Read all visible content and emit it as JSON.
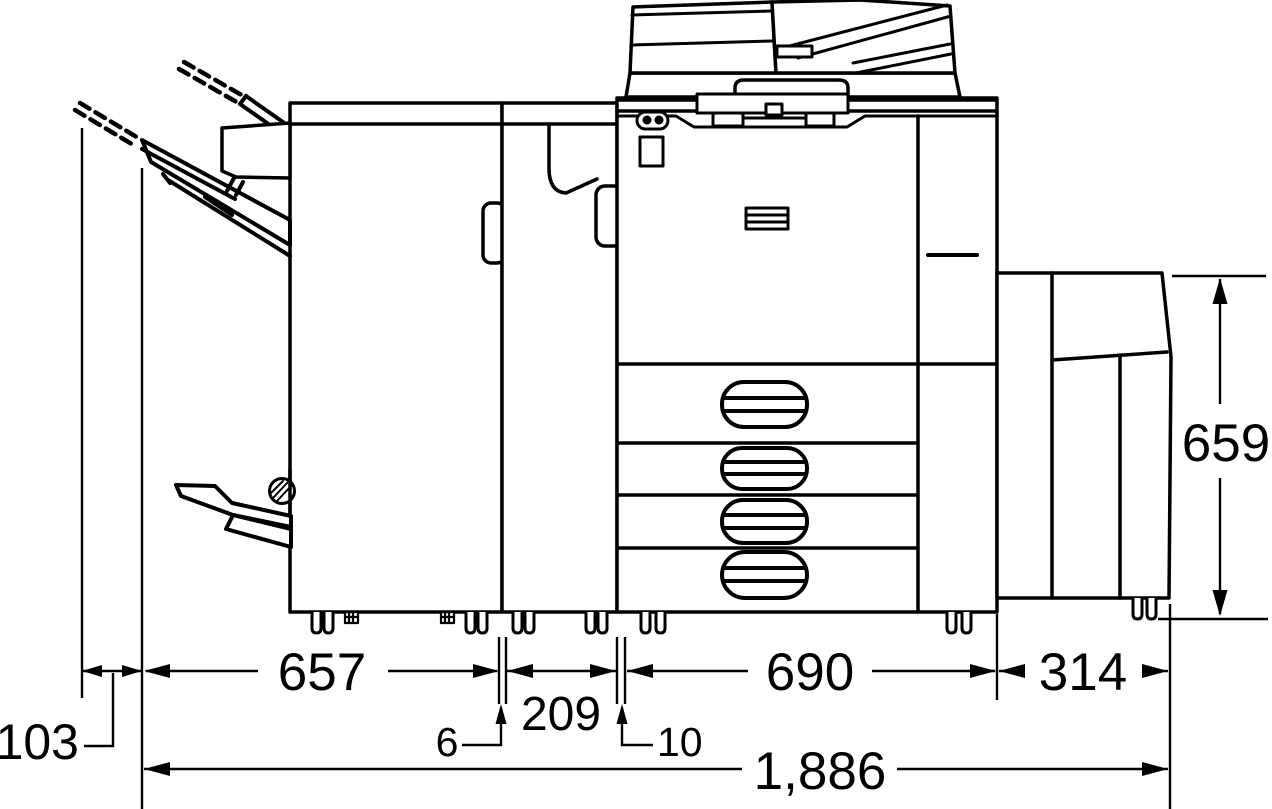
{
  "diagram": {
    "type": "technical-dimension-drawing",
    "subject": "multifunction-printer-side-elevation",
    "colors": {
      "line": "#000000",
      "background": "#ffffff"
    },
    "labels": {
      "offset_left": "103",
      "finisher_width": "657",
      "gap_finisher_bridge": "6",
      "bridge_width": "209",
      "gap_bridge_main": "10",
      "main_body_width": "690",
      "side_unit_width": "314",
      "overall_width": "1,886",
      "side_unit_height": "659"
    }
  }
}
